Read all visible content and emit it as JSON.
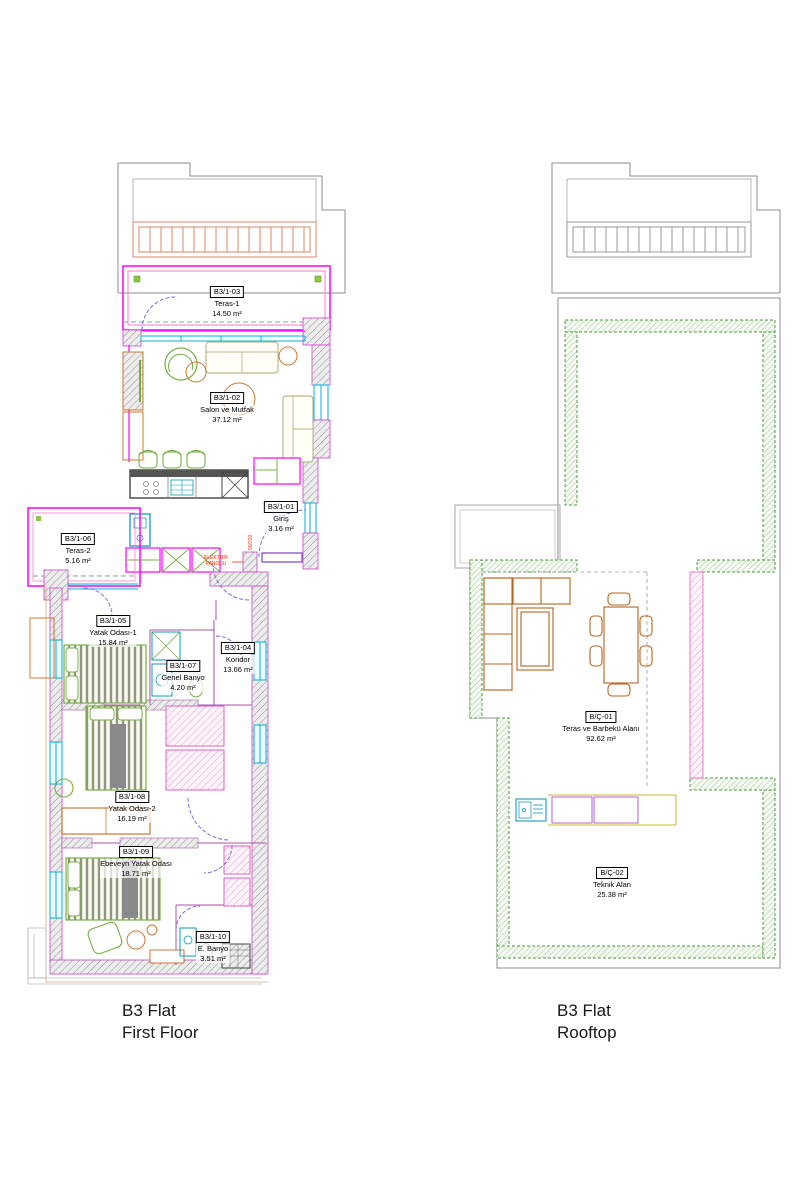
{
  "colors": {
    "wall_magenta": "#ff00ff",
    "wall_pink": "#ff7ad5",
    "window_cyan": "#00b0d8",
    "furniture_green": "#76b043",
    "furniture_orange": "#c87830",
    "railing_salmon": "#d9896a",
    "roof_gray": "#8c8c8c",
    "door_purple": "#7d6ae0",
    "rooftop_band_green": "#4e9a42",
    "rooftop_furniture_orange": "#b5651d",
    "counter_purple": "#b050d0",
    "counter_yellow": "#c8b832",
    "annotation_red": "#ff2a00"
  },
  "plans": [
    {
      "title_line1": "B3 Flat",
      "title_line2": "First Floor",
      "rooms": [
        {
          "code": "B3/1-03",
          "name": "Teras-1",
          "area": "14.50 m²"
        },
        {
          "code": "B3/1-02",
          "name": "Salon ve Mutfak",
          "area": "37.12 m²"
        },
        {
          "code": "B3/1-01",
          "name": "Giriş",
          "area": "3.16 m²"
        },
        {
          "code": "B3/1-06",
          "name": "Teras-2",
          "area": "5.16 m²"
        },
        {
          "code": "B3/1-05",
          "name": "Yatak Odası-1",
          "area": "15.84 m²"
        },
        {
          "code": "B3/1-04",
          "name": "Koridor",
          "area": "13.66 m²"
        },
        {
          "code": "B3/1-07",
          "name": "Genel Banyo",
          "area": "4.20 m²"
        },
        {
          "code": "B3/1-08",
          "name": "Yatak Odası-2",
          "area": "16.19 m²"
        },
        {
          "code": "B3/1-09",
          "name": "Ebeveyn Yatak Odası",
          "area": "18.71 m²"
        },
        {
          "code": "B3/1-10",
          "name": "E. Banyo",
          "area": "3.51 m²"
        }
      ],
      "annotations": {
        "electric_panel_line1": "ELEKTRİK",
        "electric_panel_line2": "PANOSU",
        "door_size": "90/220"
      }
    },
    {
      "title_line1": "B3 Flat",
      "title_line2": "Rooftop",
      "rooms": [
        {
          "code": "B/Ç-01",
          "name": "Teras ve Barbekü Alanı",
          "area": "92.62 m²"
        },
        {
          "code": "B/Ç-02",
          "name": "Teknik Alan",
          "area": "25.38 m²"
        }
      ]
    }
  ]
}
